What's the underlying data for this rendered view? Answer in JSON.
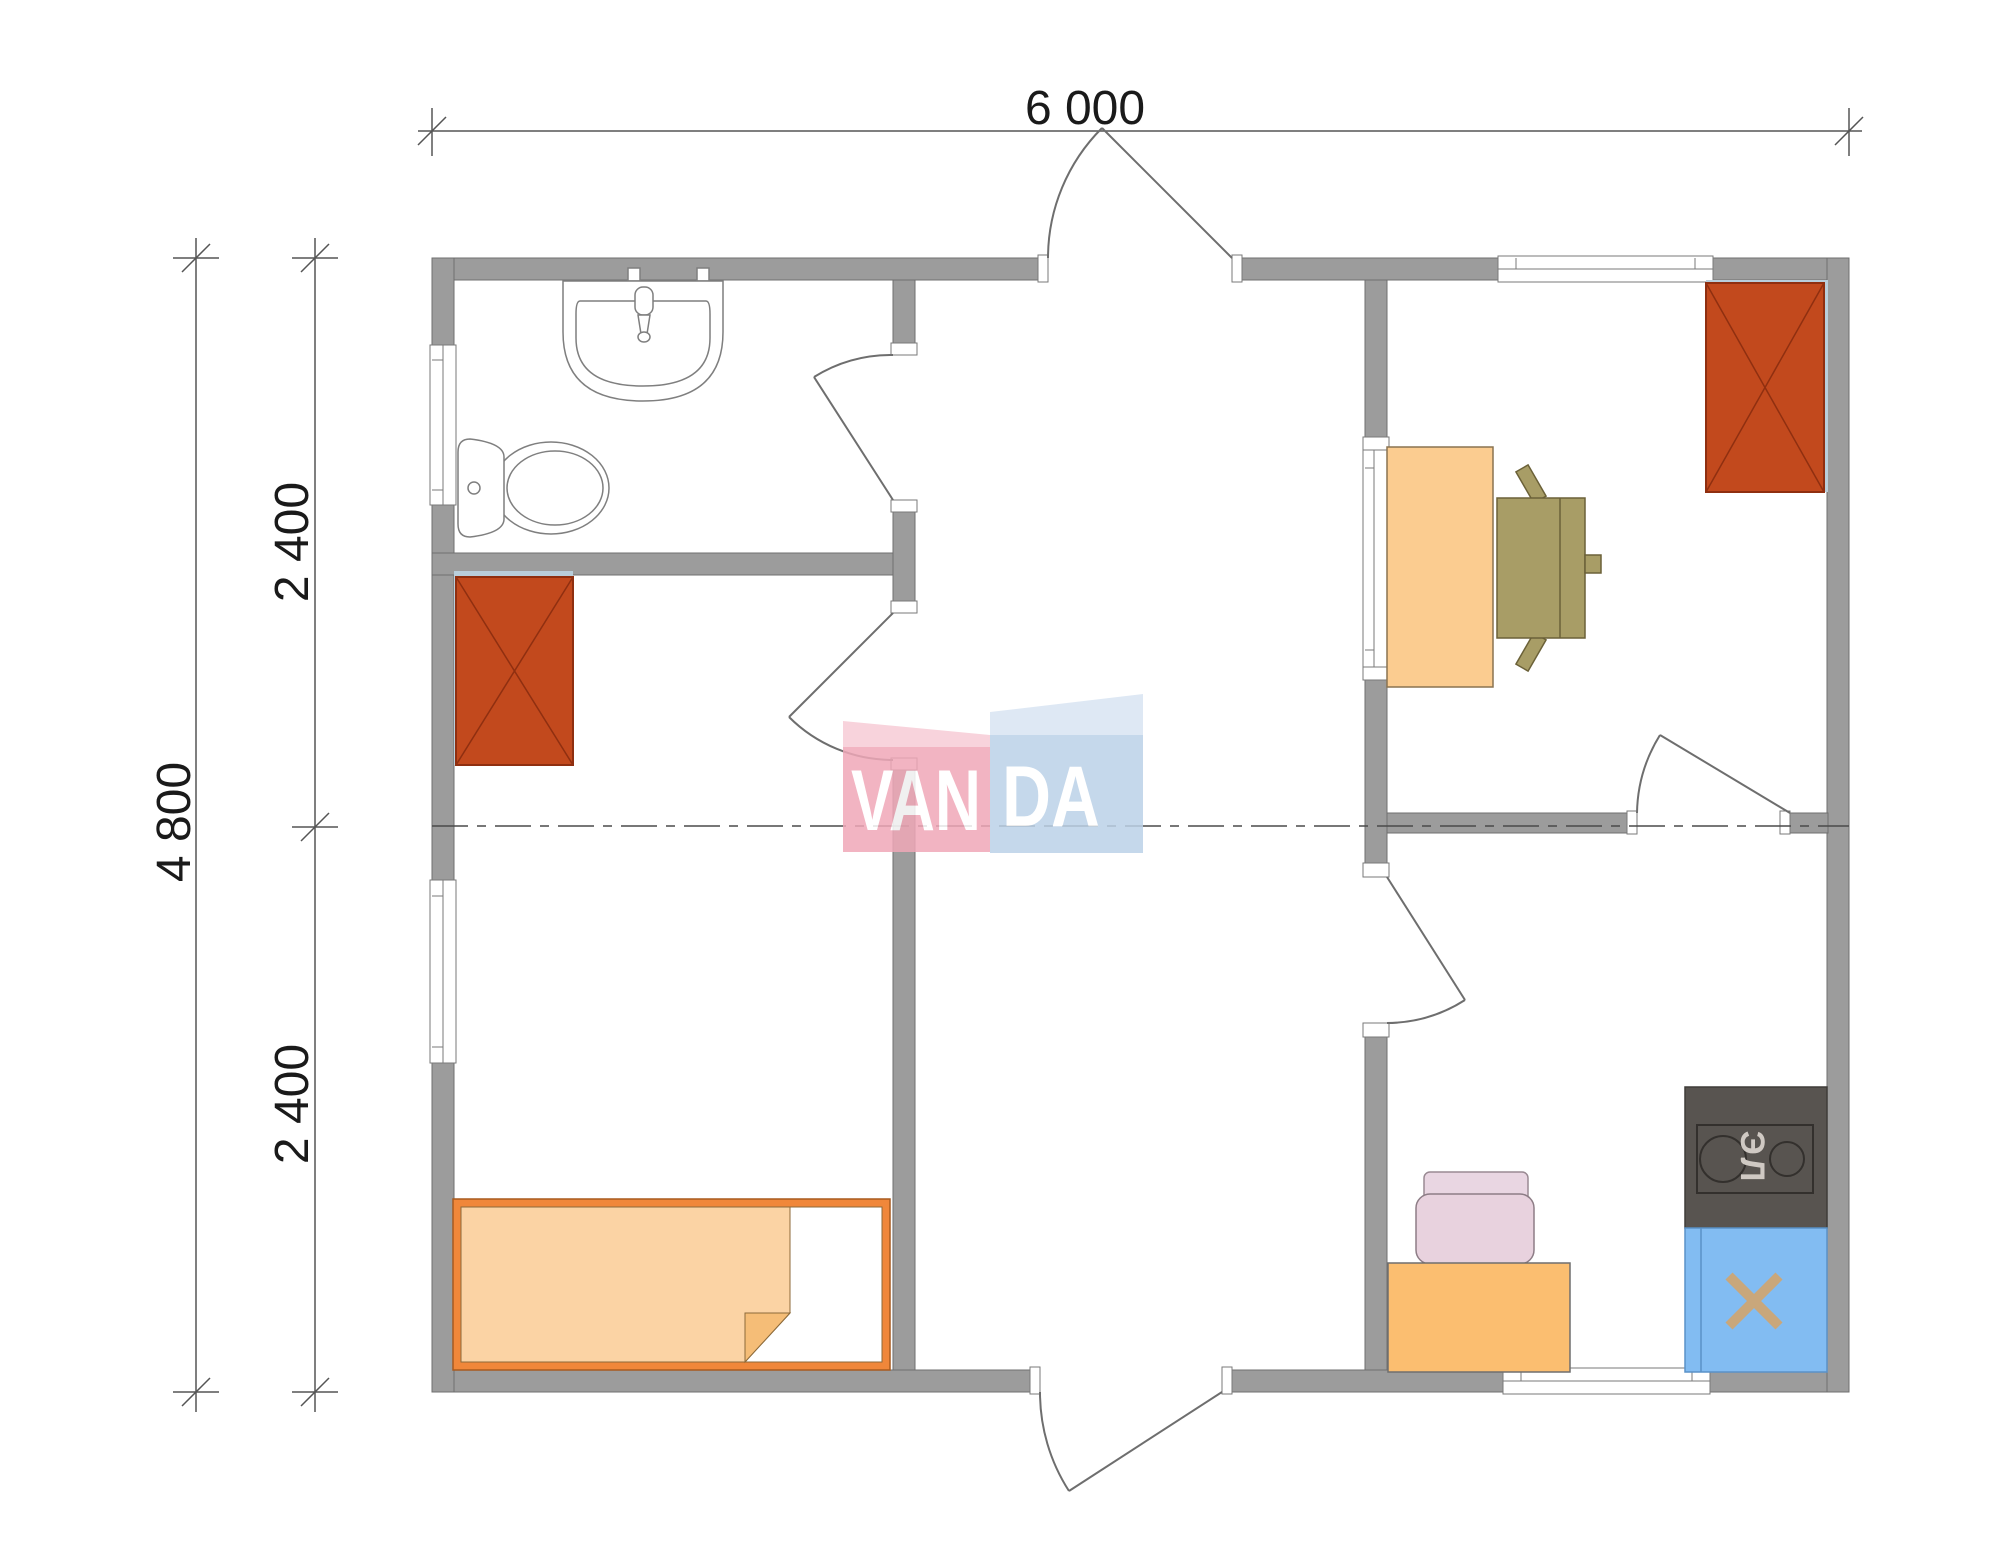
{
  "floorplan": {
    "type": "architectural-floor-plan",
    "dimensions": {
      "total_width": "6 000",
      "total_height": "4 800",
      "left_segments": [
        "2 400",
        "2 400"
      ]
    },
    "watermark": {
      "text": "VANDA",
      "part_pink": "VAN",
      "part_blue": "DA"
    },
    "labels": {
      "stove": "ЭЛ"
    },
    "colors": {
      "wall": "#9c9c9c",
      "wall_outline": "#6f6f6f",
      "wardrobe": "#c2491d",
      "wardrobe_outline": "#8f2f10",
      "wardrobe_side": "#b9cedb",
      "bed_frame": "#f0873a",
      "bedding": "#fbd3a4",
      "desk": "#fbcc90",
      "office_chair": "#a89d66",
      "kitchen_table": "#fbbe70",
      "kitchen_chair": "#e8d2de",
      "stove": "#585450",
      "stove_label": "#cfc9c3",
      "kitchen_sink": "#82bcf2",
      "faucet_cross": "#c9a77b",
      "watermark_pink": "#f0a8b8",
      "watermark_blue": "#bcd2e8"
    },
    "furniture_icons": [
      "wash-basin",
      "toilet",
      "wardrobe",
      "single-bed",
      "desk",
      "office-chair",
      "kitchen-table",
      "kitchen-chair",
      "electric-stove",
      "kitchen-sink"
    ]
  }
}
